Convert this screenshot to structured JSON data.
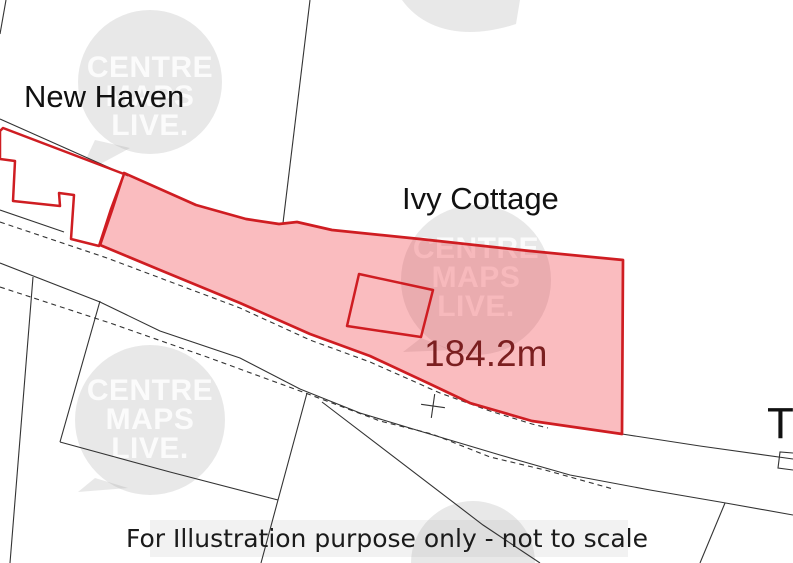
{
  "labels": {
    "new_haven": "New Haven",
    "ivy_cottage": "Ivy Cottage",
    "measurement": "184.2m",
    "t_label": "T",
    "disclaimer": "For Illustration purpose only - not to scale"
  },
  "watermark_lines": [
    "CENTRE",
    "MAPS",
    "LIVE."
  ],
  "colors": {
    "background": "#ffffff",
    "parcel_line": "#333333",
    "plot_stroke": "#cf1d22",
    "plot_fill": "rgba(237,32,42,0.30)",
    "measurement_text": "#7b1f20",
    "label_text": "#111111",
    "disclaimer_text": "#1b1b1b",
    "disclaimer_band": "rgba(0,0,0,0.05)",
    "watermark_bubble": "rgba(150,150,150,0.22)",
    "watermark_text": "rgba(255,255,255,0.82)"
  },
  "canvas": {
    "width": 793,
    "height": 563
  },
  "geometry": {
    "disclaimer_band": {
      "x": 150,
      "y": 520,
      "w": 478,
      "h": 37
    },
    "watermarks": [
      {
        "name": "watermark-bubble-topleft",
        "cx": 150,
        "cy": 82,
        "r": 72,
        "tail": [
          [
            95,
            140
          ],
          [
            78,
            176
          ],
          [
            130,
            148
          ]
        ],
        "text_cy": 69,
        "line_h": 29,
        "has_text": true
      },
      {
        "name": "watermark-bubble-center",
        "cx": 476,
        "cy": 280,
        "r": 75,
        "tail": [
          [
            421,
            338
          ],
          [
            403,
            352
          ],
          [
            452,
            350
          ]
        ],
        "text_cy": 250,
        "line_h": 29,
        "has_text": true
      },
      {
        "name": "watermark-bubble-bottomleft",
        "cx": 150,
        "cy": 420,
        "r": 75,
        "tail": [
          [
            95,
            478
          ],
          [
            78,
            492
          ],
          [
            128,
            488
          ]
        ],
        "text_cy": 392,
        "line_h": 29,
        "has_text": true
      }
    ],
    "watermark_partials": [
      {
        "name": "watermark-blob-top",
        "path": "M402,0 C425,32 468,40 516,24 L520,0 Z"
      },
      {
        "name": "watermark-blob-bottom",
        "path": "M411,563 A62,62 0 0 1 535,563 Z"
      }
    ],
    "black_lines": [
      {
        "name": "parcel-line-top-left-corner",
        "points": [
          [
            6,
            0
          ],
          [
            0,
            34
          ]
        ]
      },
      {
        "name": "parcel-line-top",
        "points": [
          [
            310,
            0
          ],
          [
            283,
            223
          ]
        ]
      },
      {
        "name": "parcel-line-above-building",
        "points": [
          [
            0,
            119
          ],
          [
            128,
            176
          ]
        ]
      },
      {
        "name": "road-upper-edge-left",
        "points": [
          [
            0,
            210
          ],
          [
            64,
            232
          ]
        ]
      },
      {
        "name": "road-lower-edge",
        "points": [
          [
            0,
            263
          ],
          [
            100,
            302
          ],
          [
            160,
            331
          ],
          [
            240,
            358
          ],
          [
            300,
            389
          ],
          [
            360,
            413
          ],
          [
            423,
            432
          ],
          [
            500,
            455
          ],
          [
            570,
            475
          ],
          [
            650,
            490
          ],
          [
            720,
            502
          ],
          [
            793,
            515
          ]
        ]
      },
      {
        "name": "road-upper-edge-right",
        "points": [
          [
            622,
            434
          ],
          [
            700,
            446
          ],
          [
            793,
            459
          ]
        ]
      },
      {
        "name": "parcel-branch-right",
        "points": [
          [
            725,
            503
          ],
          [
            700,
            563
          ]
        ]
      },
      {
        "name": "parcel-line-far-left",
        "points": [
          [
            33,
            277
          ],
          [
            10,
            563
          ]
        ]
      },
      {
        "name": "parcel-quad-left-edge",
        "points": [
          [
            100,
            301
          ],
          [
            60,
            442
          ]
        ]
      },
      {
        "name": "parcel-quad-bottom-edge",
        "points": [
          [
            60,
            442
          ],
          [
            170,
            472
          ],
          [
            278,
            500
          ]
        ]
      },
      {
        "name": "parcel-quad-right-edge",
        "points": [
          [
            307,
            393
          ],
          [
            278,
            500
          ],
          [
            261,
            563
          ]
        ]
      },
      {
        "name": "parcel-branch-center",
        "points": [
          [
            322,
            402
          ],
          [
            483,
            525
          ],
          [
            540,
            563
          ]
        ]
      },
      {
        "name": "survey-cross-arm-a",
        "points": [
          [
            421.1,
            404.3
          ],
          [
            444.9,
            407.7
          ]
        ]
      },
      {
        "name": "survey-cross-arm-b",
        "points": [
          [
            434.7,
            394.1
          ],
          [
            431.3,
            417.9
          ]
        ]
      },
      {
        "name": "small-building-right-edge",
        "points": [
          [
            793,
            453
          ],
          [
            780,
            452
          ],
          [
            778,
            468
          ],
          [
            793,
            470
          ]
        ]
      }
    ],
    "dashed_lines": [
      {
        "name": "road-dashed-upper",
        "points": [
          [
            0,
            222
          ],
          [
            107,
            258
          ],
          [
            240,
            308
          ],
          [
            310,
            340
          ],
          [
            370,
            362
          ],
          [
            440,
            393
          ],
          [
            490,
            411
          ],
          [
            532,
            424
          ],
          [
            548,
            428
          ]
        ]
      },
      {
        "name": "road-dashed-lower",
        "points": [
          [
            0,
            287
          ],
          [
            110,
            323
          ],
          [
            207,
            357
          ],
          [
            300,
            391
          ],
          [
            380,
            421
          ],
          [
            432,
            434
          ],
          [
            490,
            457
          ],
          [
            545,
            470
          ],
          [
            613,
            489
          ]
        ]
      }
    ],
    "plot_polygon": {
      "name": "highlighted-plot-boundary",
      "points": [
        [
          124,
          173
        ],
        [
          196,
          205
        ],
        [
          246,
          219
        ],
        [
          279,
          224
        ],
        [
          297,
          222
        ],
        [
          332,
          230
        ],
        [
          420,
          239
        ],
        [
          530,
          251
        ],
        [
          623,
          260
        ],
        [
          622,
          434
        ],
        [
          532,
          421
        ],
        [
          470,
          403
        ],
        [
          430,
          384
        ],
        [
          370,
          356
        ],
        [
          310,
          334
        ],
        [
          240,
          303
        ],
        [
          160,
          270
        ],
        [
          100,
          245
        ],
        [
          112,
          210
        ]
      ]
    },
    "building_polygon": {
      "name": "new-haven-building-outline",
      "points": [
        [
          0,
          131
        ],
        [
          3,
          128
        ],
        [
          124,
          174
        ],
        [
          111,
          209
        ],
        [
          99,
          246
        ],
        [
          71,
          239
        ],
        [
          74,
          195
        ],
        [
          59,
          193
        ],
        [
          60,
          206
        ],
        [
          13,
          201
        ],
        [
          15,
          161
        ],
        [
          0,
          159
        ]
      ]
    },
    "inner_building": {
      "name": "plot-building-outline",
      "points": [
        [
          359,
          274
        ],
        [
          433,
          290
        ],
        [
          421,
          337
        ],
        [
          347,
          326
        ]
      ]
    },
    "texts": [
      {
        "name": "label-new-haven",
        "bind": "labels.new_haven",
        "x": 24,
        "y": 107,
        "size": 31,
        "color": "#111111",
        "font": "sans",
        "anchor": "start",
        "bold": false
      },
      {
        "name": "label-ivy-cottage",
        "bind": "labels.ivy_cottage",
        "x": 402,
        "y": 209,
        "size": 31,
        "color": "#111111",
        "font": "sans",
        "anchor": "start",
        "bold": false
      },
      {
        "name": "label-t-partial",
        "bind": "labels.t_label",
        "x": 767,
        "y": 438,
        "size": 44,
        "color": "#111111",
        "font": "sans",
        "anchor": "start",
        "bold": false
      },
      {
        "name": "label-measurement",
        "bind": "labels.measurement",
        "x": 424,
        "y": 366,
        "size": 37,
        "color": "#7b1f20",
        "font": "sans",
        "anchor": "start",
        "bold": false
      },
      {
        "name": "label-disclaimer",
        "bind": "labels.disclaimer",
        "x": 387,
        "y": 547,
        "size": 25,
        "color": "#1b1b1b",
        "font": "dejavu",
        "anchor": "middle",
        "bold": false
      }
    ]
  }
}
